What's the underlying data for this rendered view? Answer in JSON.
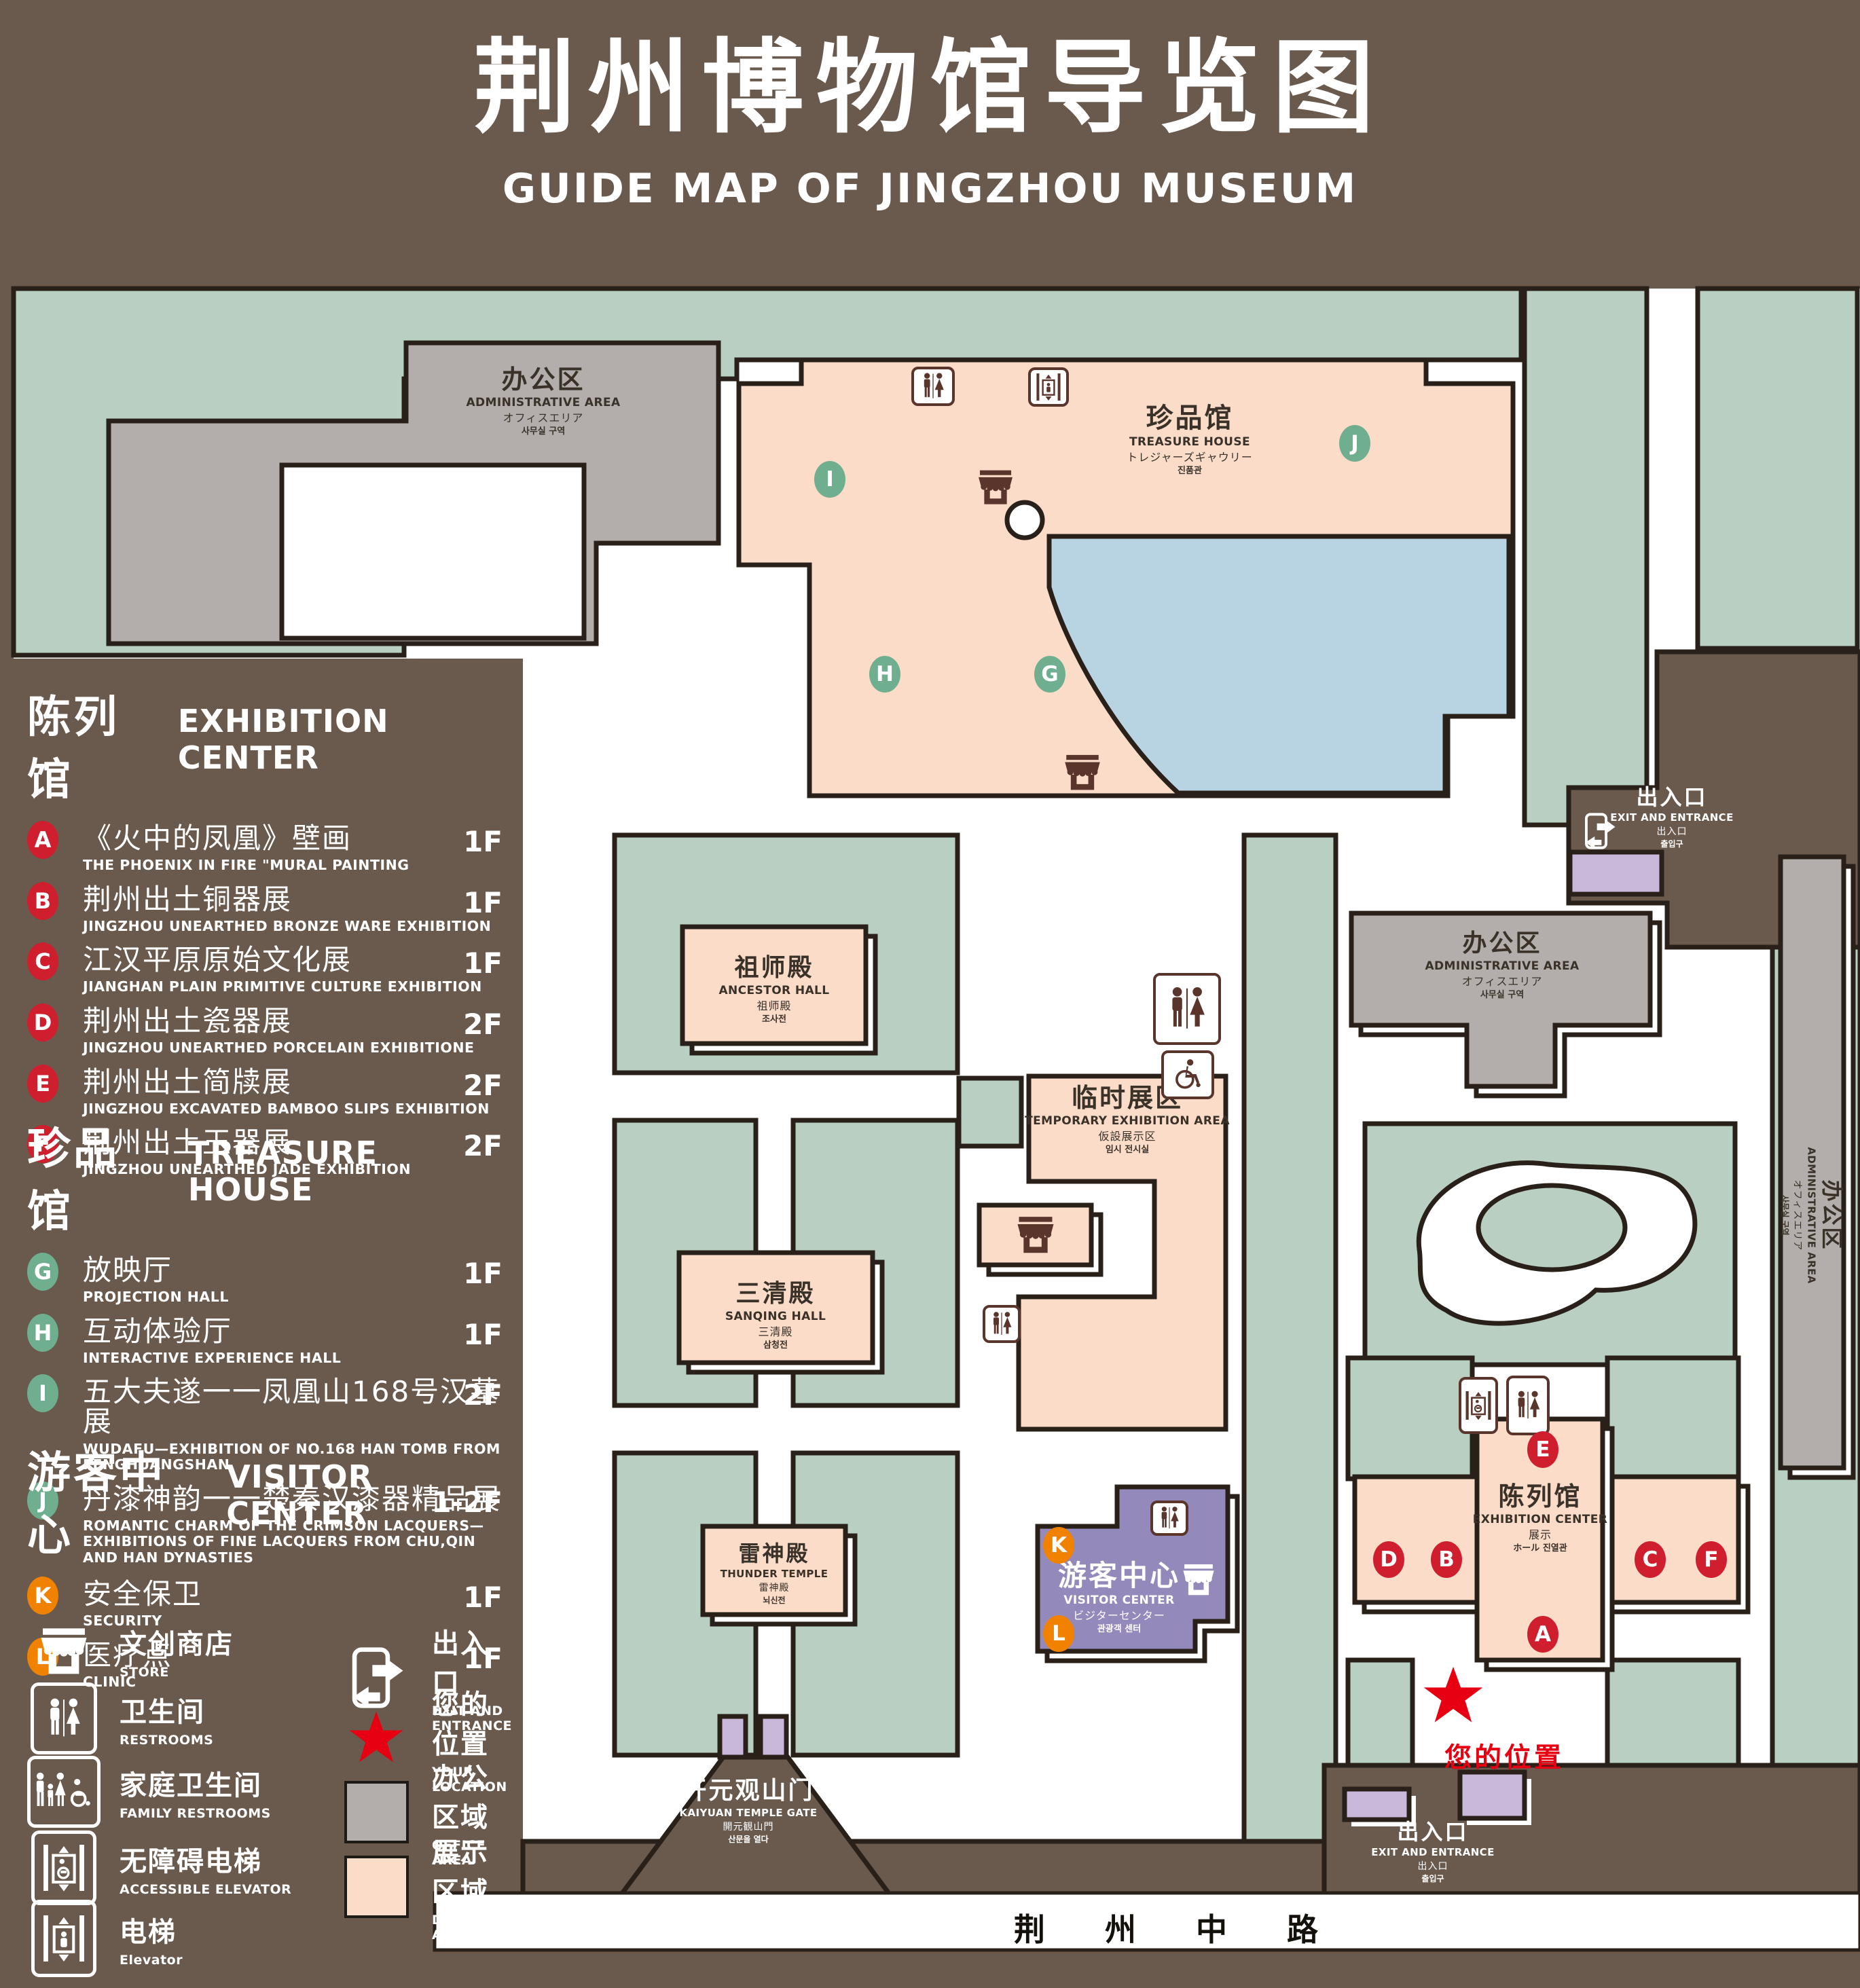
{
  "title": {
    "zh": "荆州博物馆导览图",
    "en": "GUIDE MAP OF JINGZHOU MUSEUM"
  },
  "colors": {
    "background": "#6a5a4d",
    "grounds_green": "#b9cfc1",
    "display_pink": "#fadcc8",
    "office_gray": "#b3aeab",
    "visitor_purple": "#9489bb",
    "misc_purple": "#c9b8da",
    "pond_blue": "#b8d3e1",
    "outline": "#282019",
    "badge_red": "#cf1e2e",
    "badge_green": "#6fae8e",
    "badge_orange": "#f08200",
    "location_red": "#e60012",
    "icon_brown": "#5a352c"
  },
  "legend": {
    "sections": [
      {
        "zh": "陈列馆",
        "en": "EXHIBITION CENTER",
        "items": [
          {
            "code": "A",
            "zh": "《火中的凤凰》壁画",
            "en": "THE PHOENIX IN FIRE \"MURAL PAINTING",
            "floor": "1F"
          },
          {
            "code": "B",
            "zh": "荆州出土铜器展",
            "en": "JINGZHOU UNEARTHED BRONZE WARE EXHIBITION",
            "floor": "1F"
          },
          {
            "code": "C",
            "zh": "江汉平原原始文化展",
            "en": "JIANGHAN PLAIN PRIMITIVE CULTURE EXHIBITION",
            "floor": "1F"
          },
          {
            "code": "D",
            "zh": "荆州出土瓷器展",
            "en": "JINGZHOU UNEARTHED PORCELAIN EXHIBITIONE",
            "floor": "2F"
          },
          {
            "code": "E",
            "zh": "荆州出土简牍展",
            "en": "JINGZHOU EXCAVATED BAMBOO SLIPS EXHIBITION",
            "floor": "2F"
          },
          {
            "code": "F",
            "zh": "荆州出土玉器展",
            "en": "JINGZHOU UNEARTHED JADE EXHIBITION",
            "floor": "2F"
          }
        ]
      },
      {
        "zh": "珍品馆",
        "en": "TREASURE HOUSE",
        "items": [
          {
            "code": "G",
            "zh": "放映厅",
            "en": "PROJECTION HALL",
            "floor": "1F"
          },
          {
            "code": "H",
            "zh": "互动体验厅",
            "en": "INTERACTIVE EXPERIENCE HALL",
            "floor": "1F"
          },
          {
            "code": "I",
            "zh": "五大夫遂一一凤凰山168号汉墓展",
            "en": "WUDAFU—EXHIBITION OF NO.168 HAN TOMB FROM FENGHUANGSHAN",
            "floor": "2F"
          },
          {
            "code": "J",
            "zh": "丹漆神韵一一楚秦汉漆器精品展",
            "en": "ROMANTIC CHARM OF THE CRIMSON LACQUERS—EXHIBITIONS OF FINE LACQUERS FROM CHU,QIN AND HAN DYNASTIES",
            "floor": "1-2F"
          }
        ]
      },
      {
        "zh": "游客中心",
        "en": "VISITOR CENTER",
        "items": [
          {
            "code": "K",
            "zh": "安全保卫",
            "en": "SECURITY",
            "floor": "1F"
          },
          {
            "code": "L",
            "zh": "医疗点",
            "en": "CLINIC",
            "floor": "1F"
          }
        ]
      }
    ],
    "symbols_left": [
      {
        "zh": "文创商店",
        "en": "STORE",
        "icon": "store-icon"
      },
      {
        "zh": "卫生间",
        "en": "RESTROOMS",
        "icon": "restroom-icon"
      },
      {
        "zh": "家庭卫生间",
        "en": "FAMILY RESTROOMS",
        "icon": "family-restroom-icon"
      },
      {
        "zh": "无障碍电梯",
        "en": "ACCESSIBLE ELEVATOR",
        "icon": "accessible-elevator-icon"
      },
      {
        "zh": "电梯",
        "en": "Elevator",
        "icon": "elevator-icon"
      }
    ],
    "symbols_right": [
      {
        "zh": "出入口",
        "en": "EXIT AND ENTRANCE",
        "icon": "exit-icon"
      },
      {
        "zh": "您的位置",
        "en": "YOUR LOCATION",
        "icon": "location-star-icon"
      },
      {
        "zh": "办公区域",
        "en": "OFFICE AREA",
        "swatch": "#b3aeab"
      },
      {
        "zh": "展示区域",
        "en": "DISPLAY AREA",
        "swatch": "#fadcc8"
      }
    ]
  },
  "map": {
    "labels": {
      "nw_admin": {
        "zh": "办公区",
        "en": "ADMINISTRATIVE AREA",
        "ja": "オフィスエリア",
        "ko": "사무실 구역"
      },
      "treasure": {
        "zh": "珍品馆",
        "en": "TREASURE HOUSE",
        "ja": "トレジャーズギャウリー",
        "ko": "진품관"
      },
      "ancestor": {
        "zh": "祖师殿",
        "en": "ANCESTOR HALL",
        "ja": "祖师殿",
        "ko": "조사전"
      },
      "temporary": {
        "zh": "临时展区",
        "en": "TEMPORARY EXHIBITION AREA",
        "ja": "仮設展示区",
        "ko": "임시 전시실"
      },
      "sanqing": {
        "zh": "三清殿",
        "en": "SANQING HALL",
        "ja": "三清殿",
        "ko": "삼청전"
      },
      "thunder": {
        "zh": "雷神殿",
        "en": "THUNDER TEMPLE",
        "ja": "雷神殿",
        "ko": "뇌신전"
      },
      "visitor": {
        "zh": "游客中心",
        "en": "VISITOR CENTER",
        "ja": "ビジターセンター",
        "ko": "관광객 센터"
      },
      "e_admin": {
        "zh": "办公区",
        "en": "ADMINISTRATIVE AREA",
        "ja": "オフィスエリア",
        "ko": "사무실 구역"
      },
      "far_admin": {
        "zh": "办公区",
        "en": "ADMINISTRATIVE AREA",
        "ja": "オフィスエリア",
        "ko": "사무실 구역"
      },
      "exhibition": {
        "zh": "陈列馆",
        "en": "EXHIBITION CENTER",
        "ja": "展示",
        "ko": "ホール 진열관"
      },
      "ne_exit": {
        "zh": "出入口",
        "en": "EXIT AND ENTRANCE",
        "ja": "出入口",
        "ko": "출입구"
      },
      "se_exit": {
        "zh": "出入口",
        "en": "EXIT AND ENTRANCE",
        "ja": "出入口",
        "ko": "출입구"
      },
      "gate": {
        "zh": "开元观山门",
        "en": "KAIYUAN TEMPLE GATE",
        "ja": "開元観山門",
        "ko": "산문을 열다"
      }
    },
    "road": "荆 州 中 路",
    "your_location": "您的位置",
    "markers": [
      {
        "letter": "I",
        "color": "green"
      },
      {
        "letter": "J",
        "color": "green"
      },
      {
        "letter": "H",
        "color": "green"
      },
      {
        "letter": "G",
        "color": "green"
      },
      {
        "letter": "E",
        "color": "red"
      },
      {
        "letter": "D",
        "color": "red"
      },
      {
        "letter": "B",
        "color": "red"
      },
      {
        "letter": "C",
        "color": "red"
      },
      {
        "letter": "F",
        "color": "red"
      },
      {
        "letter": "A",
        "color": "red"
      },
      {
        "letter": "K",
        "color": "orange"
      },
      {
        "letter": "L",
        "color": "orange"
      }
    ]
  }
}
